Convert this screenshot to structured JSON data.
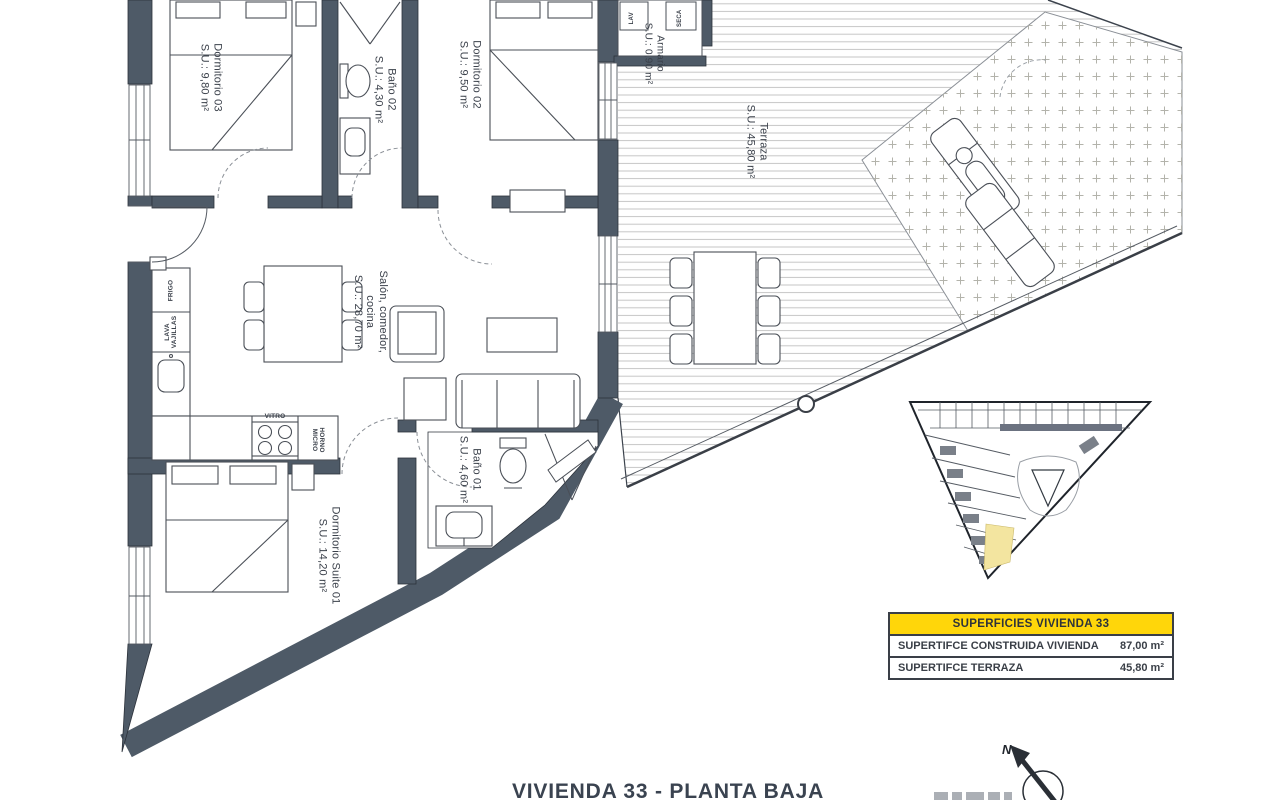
{
  "title": "VIVIENDA 33 - PLANTA BAJA",
  "rooms": {
    "dorm03": {
      "name": "Dormitorio 03",
      "area": "S.U.: 9,80 m²"
    },
    "bano02": {
      "name": "Baño 02",
      "area": "S.U.: 4,30 m²"
    },
    "dorm02": {
      "name": "Dormitorio 02",
      "area": "S.U.: 9,50 m²"
    },
    "armario": {
      "name": "Armario",
      "area": "S.U.: 0,90 m²"
    },
    "terraza": {
      "name": "Terraza",
      "area": "S.U.: 45,80 m²"
    },
    "salon": {
      "line1": "Salón, comedor,",
      "line2": "cocina",
      "area": "S.U.: 28,70 m²"
    },
    "bano01": {
      "name": "Baño 01",
      "area": "S.U.: 4,60 m²"
    },
    "suite": {
      "name": "Dormitorio Suite 01",
      "area": "S.U.: 14,20 m²"
    }
  },
  "kitchen_labels": {
    "fridge": "FRIGO",
    "dishwasher_line1": "LAVA",
    "dishwasher_line2": "VAJILLAS",
    "hob": "VITRO",
    "oven_line1": "HORNO",
    "oven_line2": "MICRO"
  },
  "closet_labels": {
    "washer": "LAV",
    "dryer": "SECA"
  },
  "summary_table": {
    "header": "SUPERFICIES VIVIENDA 33",
    "rows": [
      {
        "label": "SUPERTIFCE CONSTRUIDA VIVIENDA",
        "value": "87,00 m²"
      },
      {
        "label": "SUPERTIFCE TERRAZA",
        "value": "45,80 m²"
      }
    ]
  },
  "compass": {
    "north": "N"
  },
  "colors": {
    "wall": "#4e5a67",
    "table_header_bg": "#ffd60a",
    "site_unit_highlight": "#f3e5a0",
    "deck_line": "#c6c6c6"
  }
}
